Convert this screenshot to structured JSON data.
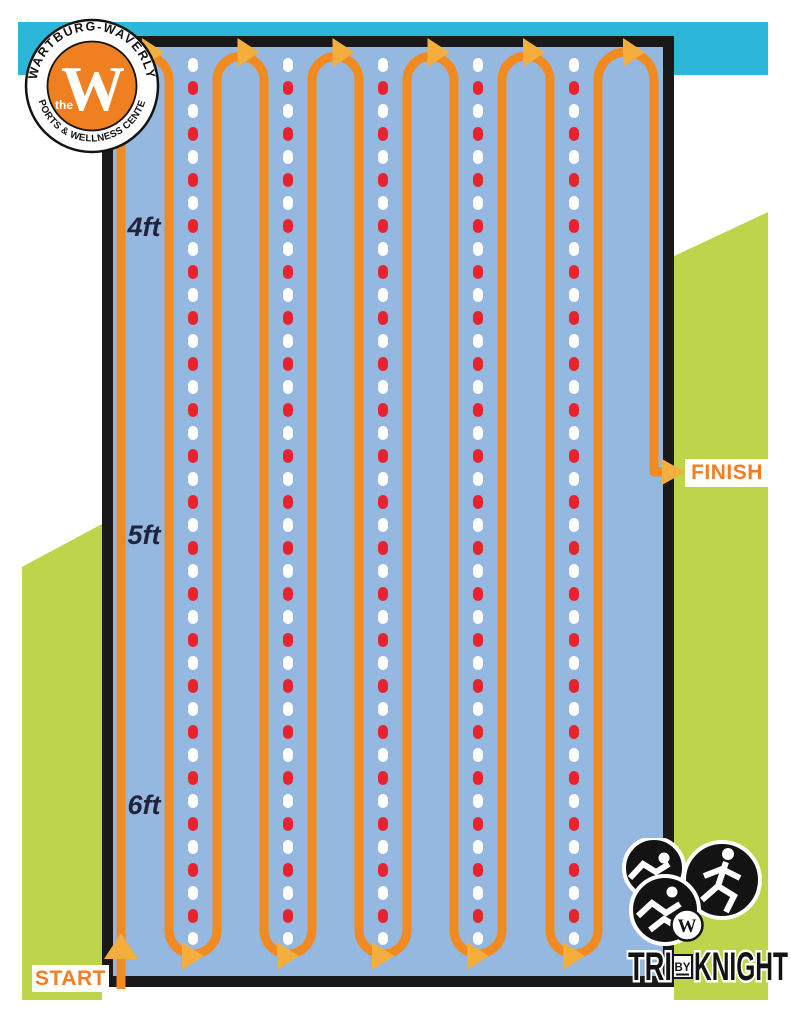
{
  "course": {
    "start_label": "START",
    "finish_label": "FINISH",
    "depth_markers": [
      {
        "label": "4ft",
        "y": 228
      },
      {
        "label": "5ft",
        "y": 536
      },
      {
        "label": "6ft",
        "y": 806
      }
    ],
    "path": {
      "verticals": [
        121,
        169,
        217,
        264,
        312,
        359,
        407,
        454,
        502,
        550,
        598,
        654
      ],
      "lane_lines_x": [
        193,
        288,
        383,
        478,
        574
      ],
      "lane_top_y": 63,
      "lane_bottom_y": 940,
      "top_y": 80,
      "bottom_y": 930,
      "start_y": 989,
      "finish_y": 472,
      "finish_end_x": 667
    }
  },
  "branding": {
    "top_left_badge": {
      "arc_top": "WARTBURG-WAVERLY",
      "arc_bottom": "SPORTS & WELLNESS CENTER",
      "the_word": "the",
      "letter": "W"
    },
    "bottom_right_badge": {
      "tri": "TRI",
      "by": "BY",
      "knight": "KNIGHT",
      "letter": "W"
    }
  },
  "colors": {
    "teal": "#2bb6da",
    "green": "#bdd44b",
    "pool_blue": "#94b8e0",
    "border_black": "#1a1818",
    "path_orange": "#f18a21",
    "arrow_gold": "#f3ae3d",
    "lane_red": "#e8232d",
    "lane_white": "#ffffff",
    "depth_label_dark": "#21233b",
    "start_finish_orange": "#f47d21",
    "badge_orange": "#f07f22",
    "logo_black": "#131313"
  }
}
